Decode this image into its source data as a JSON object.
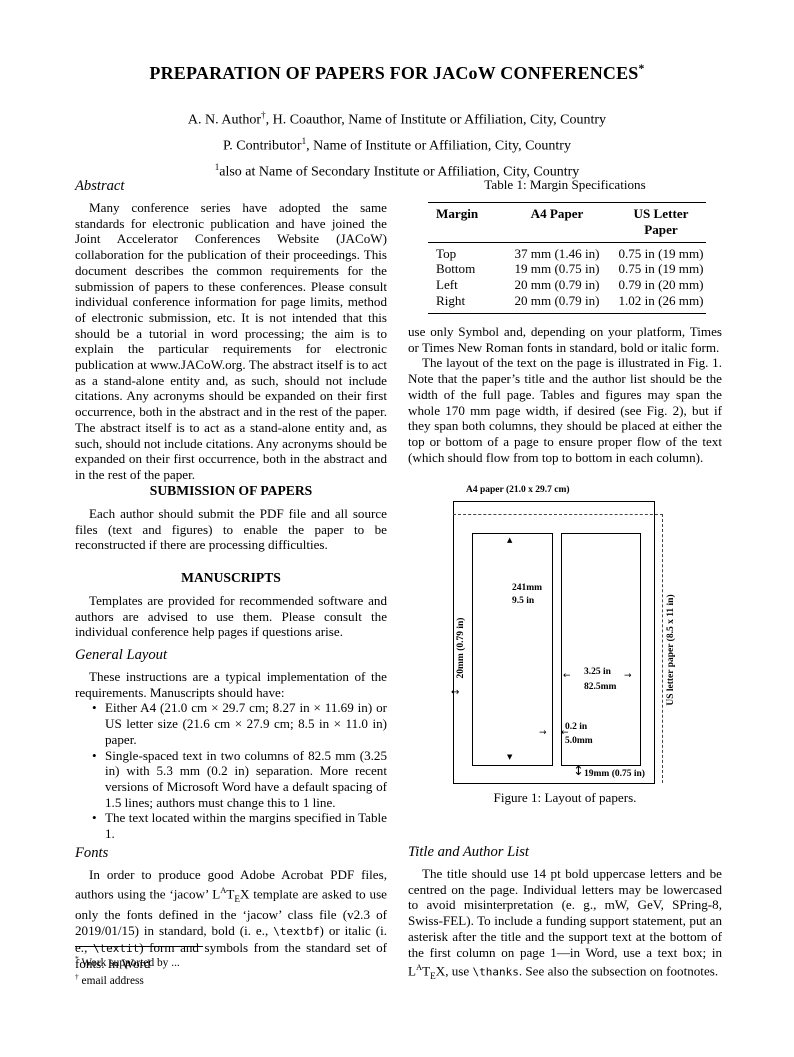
{
  "page": {
    "title_segments": [
      {
        "t": "PREPARATION OF PAPERS FOR JACoW CONFERENCES"
      },
      {
        "t": "*",
        "s": "sup"
      }
    ],
    "authors": [
      [
        {
          "t": "A. N. Author"
        },
        {
          "t": "†",
          "s": "sup"
        },
        {
          "t": ", H. Coauthor, Name of Institute or Affiliation, City, Country"
        }
      ],
      [
        {
          "t": "P. Contributor"
        },
        {
          "t": "1",
          "s": "sup"
        },
        {
          "t": ", Name of Institute or Affiliation, City, Country"
        }
      ],
      [
        {
          "t": "1",
          "s": "sup"
        },
        {
          "t": "also at Name of Secondary Institute or Affiliation, City, Country"
        }
      ]
    ]
  },
  "left_column": {
    "abstract": {
      "heading": "Abstract",
      "text": "Many conference series have adopted the same standards for electronic publication and have joined the Joint Accelerator Conferences Website (JACoW) collaboration for the publication of their proceedings. This document describes the common requirements for the submission of papers to these conferences. Please consult individual conference information for page limits, method of electronic submission, etc. It is not intended that this should be a tutorial in word processing; the aim is to explain the particular requirements for electronic publication at www.JACoW.org. The abstract itself is to act as a stand-alone entity and, as such, should not include citations. Any acronyms should be expanded on their first occurrence, both in the abstract and in the rest of the paper. The abstract itself is to act as a stand-alone entity and, as such, should not include citations. Any acronyms should be expanded on their first occurrence, both in the abstract and in the rest of the paper."
    },
    "submission": {
      "heading": "SUBMISSION OF PAPERS",
      "text": "Each author should submit the PDF file and all source files (text and figures) to enable the paper to be reconstructed if there are processing difficulties."
    },
    "manuscripts": {
      "heading": "MANUSCRIPTS",
      "text": "Templates are provided for recommended software and authors are advised to use them. Please consult the individual conference help pages if questions arise."
    },
    "general_layout": {
      "heading": "General Layout",
      "intro": "These instructions are a typical implementation of the requirements. Manuscripts should have:",
      "bullets": [
        "Either A4 (21.0 cm × 29.7 cm; 8.27 in × 11.69 in) or US letter size (21.6 cm × 27.9 cm; 8.5 in × 11.0 in) paper.",
        "Single-spaced text in two columns of 82.5 mm (3.25 in) with 5.3 mm (0.2 in) separation. More recent versions of Microsoft Word have a default spacing of 1.5 lines; authors must change this to 1 line.",
        "The text located within the margins specified in Table 1."
      ]
    },
    "fonts": {
      "heading": "Fonts",
      "segments": [
        {
          "t": "In order to produce good Adobe Acrobat PDF files, authors using the ‘jacow’ "
        },
        {
          "t": "L"
        },
        {
          "t": "A",
          "s": "sup"
        },
        {
          "t": "T"
        },
        {
          "t": "E",
          "s": "sub"
        },
        {
          "t": "X"
        },
        {
          "t": " template are asked to use only the fonts defined in the ‘jacow’ class file (v2.3 of 2019/01/15) in standard, bold (i. e., "
        },
        {
          "t": "\\textbf",
          "s": "mono"
        },
        {
          "t": ") or italic (i. e., "
        },
        {
          "t": "\\textit",
          "s": "mono"
        },
        {
          "t": ") form and symbols from the standard set of fonts. In Word"
        }
      ]
    },
    "footnotes": [
      [
        {
          "t": "*",
          "s": "sup"
        },
        {
          "t": " Work supported by ..."
        }
      ],
      [
        {
          "t": "†",
          "s": "sup"
        },
        {
          "t": " email address"
        }
      ]
    ]
  },
  "right_column": {
    "table": {
      "caption": "Table 1: Margin Specifications",
      "headers": [
        "Margin",
        "A4 Paper",
        "US Letter Paper"
      ],
      "rows": [
        [
          "Top",
          "37 mm (1.46 in)",
          "0.75 in (19 mm)"
        ],
        [
          "Bottom",
          "19 mm (0.75 in)",
          "0.75 in (19 mm)"
        ],
        [
          "Left",
          "20 mm (0.79 in)",
          "0.79 in (20 mm)"
        ],
        [
          "Right",
          "20 mm (0.79 in)",
          "1.02 in (26 mm)"
        ]
      ]
    },
    "body_text_1": "use only Symbol and, depending on your platform, Times or Times New Roman fonts in standard, bold or italic form.",
    "body_text_2": "The layout of the text on the page is illustrated in Fig. 1. Note that the paper’s title and the author list should be the width of the full page. Tables and figures may span the whole 170 mm page width, if desired (see Fig. 2), but if they span both columns, they should be placed at either the top or bottom of a page to ensure proper flow of the text (which should flow from top to bottom in each column).",
    "figure": {
      "top_label": "A4 paper (21.0 x 29.7 cm)",
      "left_margin_label": "20mm (0.79 in)",
      "right_label": "US letter paper (8.5 x 11 in)",
      "col_height_mm": "241mm",
      "col_height_in": "9.5 in",
      "col_width_in": "3.25 in",
      "col_width_mm": "82.5mm",
      "gap_in": "0.2 in",
      "gap_mm": "5.0mm",
      "bottom_margin_label": "19mm (0.75 in)",
      "caption": "Figure 1: Layout of papers."
    },
    "title_author_list": {
      "heading": "Title and Author List",
      "segments": [
        {
          "t": "The title should use 14 pt bold uppercase letters and be centred on the page. Individual letters may be lowercased to avoid misinterpretation (e. g., mW, GeV, SPring-8, Swiss-FEL). To include a funding support statement, put an asterisk after the title and the support text at the bottom of the first column on page 1—in Word, use a text box; in "
        },
        {
          "t": "L"
        },
        {
          "t": "A",
          "s": "sup"
        },
        {
          "t": "T"
        },
        {
          "t": "E",
          "s": "sub"
        },
        {
          "t": "X"
        },
        {
          "t": ", use "
        },
        {
          "t": "\\thanks",
          "s": "mono"
        },
        {
          "t": ". See also the subsection on footnotes."
        }
      ]
    }
  }
}
